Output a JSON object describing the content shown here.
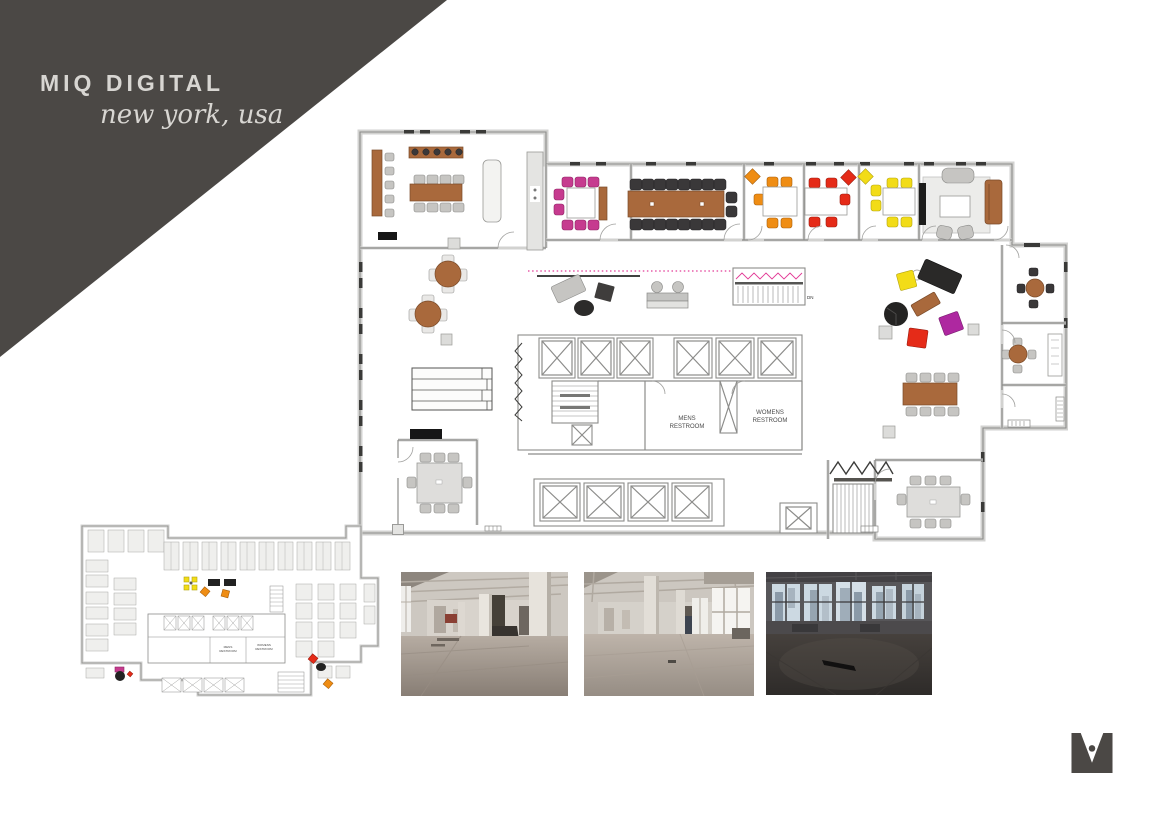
{
  "banner": {
    "title": "MIQ DIGITAL",
    "subtitle": "new york, usa"
  },
  "plan_labels": {
    "mens_1": "MENS",
    "mens_2": "RESTROOM",
    "womens_1": "WOMENS",
    "womens_2": "RESTROOM",
    "stair_dn": "DN"
  },
  "palette": {
    "banner": "#4b4845",
    "banner_text": "#d8d6d2",
    "wall_light": "#d2d2d0",
    "wall_line": "#8c8c8a",
    "brown": "#a9693c",
    "brown_dark": "#7a4a28",
    "magenta": "#c63b8f",
    "purple": "#ae28a0",
    "orange": "#ef8d14",
    "red": "#e52b18",
    "yellow": "#f2dc17",
    "dark": "#3a3839",
    "chair_gray": "#c6c5c2",
    "chair_light": "#e9e8e6",
    "dotline": "#e23a96",
    "black": "#161616",
    "logo": "#4b4845"
  }
}
